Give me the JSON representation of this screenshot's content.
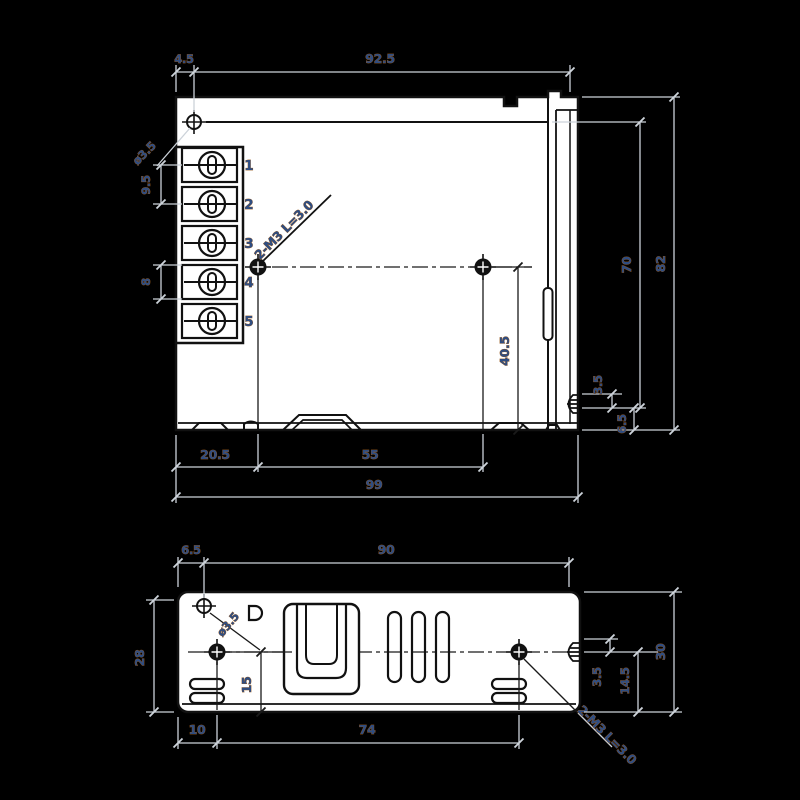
{
  "drawing_title": "power-supply-mechanical-drawing",
  "colors": {
    "background": "#000000",
    "body_fill": "#ffffff",
    "linework": "#111111",
    "dimension_text": "#2e4d82",
    "dimension_lines": "#ccd2d9"
  },
  "front_view": {
    "dim_left_offset": "4.5",
    "dim_inner_width": "92.5",
    "hole_dia_label": "ø3.5",
    "dim_terminal_pitch_ac": "9.5",
    "dim_terminal_pitch_dc": "8",
    "screw_label": "2-M3 L=3.0",
    "terminals": [
      "1",
      "2",
      "3",
      "4",
      "5"
    ],
    "dim_inner_height": "70",
    "dim_height": "82",
    "dim_hole_to_bottom": "40.5",
    "dim_tab_gap": "3.5",
    "dim_tab_height": "6.5",
    "dim_hole_left": "20.5",
    "dim_hole_pitch": "55",
    "dim_width": "99"
  },
  "bottom_view": {
    "dim_left_offset": "6.5",
    "dim_inner_width": "90",
    "hole_dia_label": "ø3.5",
    "dim_left_height": "28",
    "dim_hole_to_bottom": "15",
    "dim_hole_left": "10",
    "dim_hole_pitch": "74",
    "dim_tab_gap": "3.5",
    "dim_center_to_bottom": "14.5",
    "dim_height": "30",
    "screw_label": "2-M3 L=3.0"
  }
}
